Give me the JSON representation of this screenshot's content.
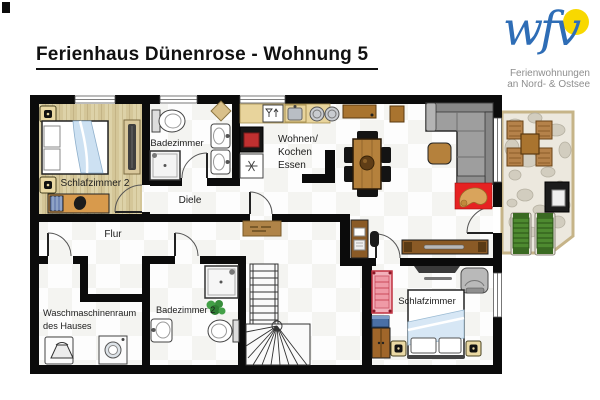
{
  "title": "Ferienhaus Dünenrose - Wohnung 5",
  "logo": {
    "brand": "wfv",
    "tagline": [
      "Ferienwohnungen",
      "an Nord- & Ostsee"
    ],
    "brand_color": "#2e6db6",
    "sun_color": "#f8d800"
  },
  "rooms": {
    "schlafzimmer2": "Schlafzimmer 2",
    "badezimmer": "Badezimmer",
    "wohnen_kochen_essen": [
      "Wohnen/",
      "Kochen",
      "Essen"
    ],
    "diele": "Diele",
    "flur": "Flur",
    "waschmaschinenraum": [
      "Waschmaschinenraum",
      "des Hauses"
    ],
    "badezimmer2": "Badezimmer 2",
    "schlafzimmer": "Schlafzimmer"
  },
  "colors": {
    "wall": "#0b0b0b",
    "wood_floor": "#d9cda2",
    "rug_red": "#e62222",
    "dog_tan": "#d9a45c",
    "terrace_wood": "#b5824a",
    "lounger_green": "#4e8a30",
    "crib_pink": "#f2b0ba"
  }
}
